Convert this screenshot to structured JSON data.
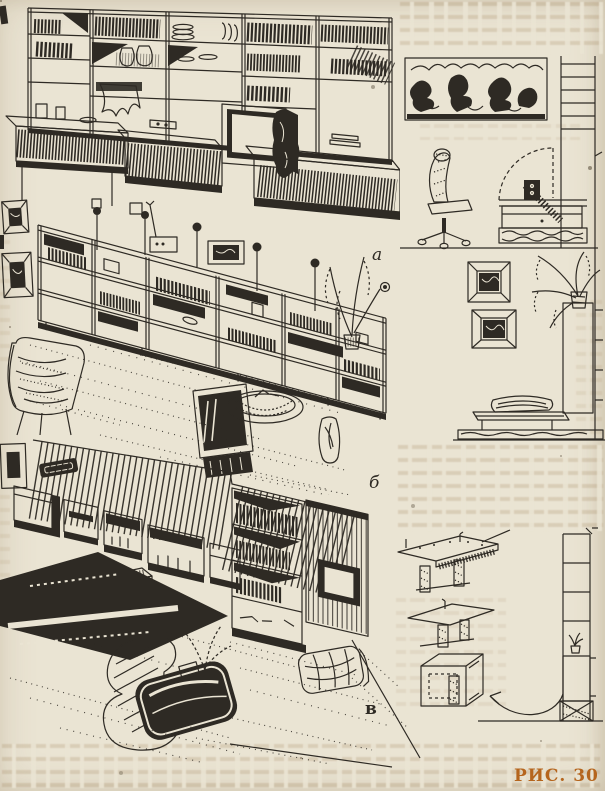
{
  "page": {
    "background_color": "#eae4d3",
    "ink_color": "#2e2a24",
    "caption": "РИС. 30",
    "caption_color": "#b5651d",
    "labels": {
      "a": "а",
      "b": "б",
      "v": "в"
    }
  }
}
